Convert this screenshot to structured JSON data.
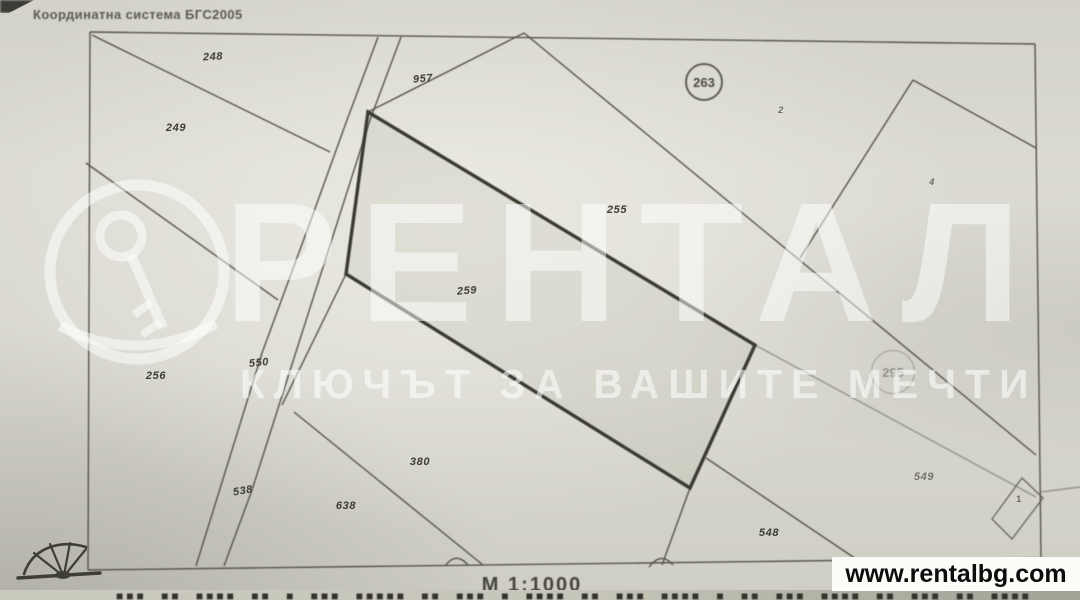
{
  "header": {
    "coordinate_system": "Координатна система БГС2005"
  },
  "map": {
    "parcels": [
      {
        "label": "248",
        "circled": false
      },
      {
        "label": "249",
        "circled": false
      },
      {
        "label": "957",
        "circled": false
      },
      {
        "label": "255",
        "circled": false
      },
      {
        "label": "259",
        "circled": false
      },
      {
        "label": "263",
        "circled": true
      },
      {
        "label": "2",
        "circled": false
      },
      {
        "label": "4",
        "circled": false
      },
      {
        "label": "295",
        "circled": true
      },
      {
        "label": "256",
        "circled": false
      },
      {
        "label": "550",
        "circled": false
      },
      {
        "label": "538",
        "circled": false
      },
      {
        "label": "638",
        "circled": false
      },
      {
        "label": "380",
        "circled": false
      },
      {
        "label": "548",
        "circled": false
      },
      {
        "label": "549",
        "circled": false
      },
      {
        "label": "1",
        "circled": false
      }
    ]
  },
  "watermark": {
    "brand": "РЕНТАЛ",
    "tagline": "КЛЮЧЪТ ЗА ВАШИТЕ МЕЧТИ",
    "logo_icon": "key-in-circle"
  },
  "footer": {
    "scale": "М 1:1000",
    "website": "www.rentalbg.com",
    "illegible_row": "■■■ ■■ ■■■■ ■■ ■ ■■■ ■■■■■ ■■ ■■■ ■ ■■■■ ■■ ■■■ ■■■■ ■ ■■ ■■■ ■■■■ ■■ ■■■ ■■ ■■■■"
  },
  "icons": {
    "corner_mark": "surveyor-sketch-icon"
  },
  "colors": {
    "paper": "#d8d7cf",
    "line": "#56554b",
    "bold_parcel_line": "#3b3a32",
    "watermark": "#ffffff",
    "badge_bg": "#fcfcf9",
    "badge_text": "#0c0c0c"
  }
}
